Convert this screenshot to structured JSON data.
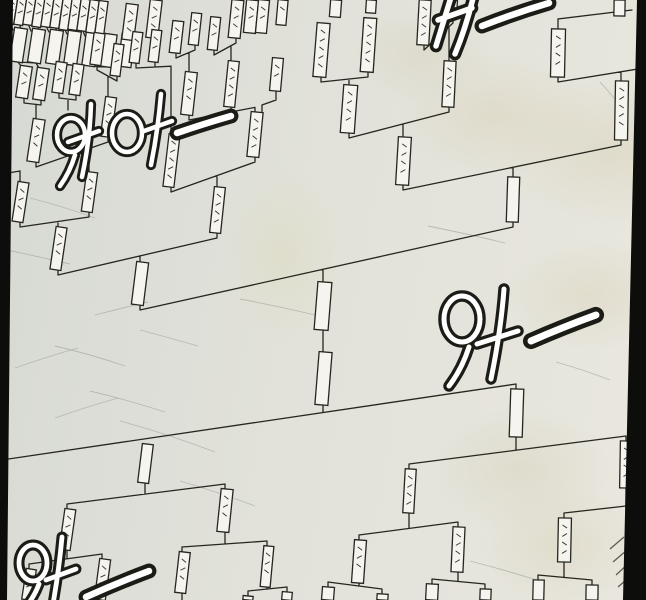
{
  "panel": {
    "scene_label": "tournament-bracket-wall",
    "sfx": [
      {
        "id": "cheer-top-left",
        "text": "와아—"
      },
      {
        "id": "cheer-top-right",
        "text": "와—"
      },
      {
        "id": "cheer-middle",
        "text": "와—"
      },
      {
        "id": "cheer-bottom-left",
        "text": "와—"
      }
    ]
  },
  "colors": {
    "ink": "#26261f",
    "box_fill": "#f5f4ee",
    "scribble": "#20201b",
    "scratch": "#a9aea6",
    "hatch": "#3b3b36",
    "border": "#0d0d0b"
  },
  "bracket": {
    "boxes": [
      [
        7,
        -6,
        9,
        30
      ],
      [
        16,
        -5,
        9,
        30
      ],
      [
        25,
        -5,
        9,
        30
      ],
      [
        34,
        -4,
        9,
        31
      ],
      [
        43,
        -4,
        9,
        31
      ],
      [
        52,
        -3,
        9,
        31
      ],
      [
        61,
        -2,
        9,
        32
      ],
      [
        70,
        -2,
        9,
        32
      ],
      [
        79,
        -1,
        9,
        32
      ],
      [
        88,
        0,
        9,
        33
      ],
      [
        97,
        1,
        9,
        33
      ],
      [
        12,
        28,
        13,
        34,
        0
      ],
      [
        30,
        29,
        13,
        34,
        0
      ],
      [
        48,
        30,
        13,
        34,
        0
      ],
      [
        66,
        31,
        13,
        34,
        0
      ],
      [
        84,
        33,
        13,
        33,
        0
      ],
      [
        102,
        34,
        13,
        33,
        0
      ],
      [
        120,
        34,
        13,
        33,
        0
      ],
      [
        124,
        4,
        12,
        36
      ],
      [
        148,
        0,
        12,
        38
      ],
      [
        230,
        0,
        12,
        38
      ],
      [
        245,
        0,
        12,
        33
      ],
      [
        257,
        0,
        11,
        33
      ],
      [
        277,
        0,
        10,
        25
      ],
      [
        330,
        0,
        11,
        17,
        0
      ],
      [
        366,
        0,
        10,
        13,
        0
      ],
      [
        418,
        0,
        12,
        45
      ],
      [
        446,
        0,
        11,
        18
      ],
      [
        614,
        0,
        11,
        16
      ],
      [
        18,
        66,
        12,
        32
      ],
      [
        35,
        68,
        12,
        32
      ],
      [
        54,
        62,
        11,
        31
      ],
      [
        71,
        64,
        11,
        31
      ],
      [
        92,
        33,
        11,
        32
      ],
      [
        112,
        44,
        10,
        32
      ],
      [
        131,
        32,
        10,
        31
      ],
      [
        150,
        30,
        10,
        32
      ],
      [
        171,
        21,
        11,
        32
      ],
      [
        190,
        13,
        10,
        32
      ],
      [
        209,
        17,
        10,
        33
      ],
      [
        271,
        58,
        11,
        33
      ],
      [
        315,
        23,
        13,
        54
      ],
      [
        362,
        18,
        13,
        54
      ],
      [
        30,
        119,
        12,
        43
      ],
      [
        103,
        97,
        11,
        40
      ],
      [
        183,
        72,
        12,
        43
      ],
      [
        226,
        61,
        11,
        46
      ],
      [
        166,
        134,
        11,
        53
      ],
      [
        249,
        112,
        12,
        45
      ],
      [
        15,
        182,
        11,
        40
      ],
      [
        84,
        172,
        11,
        40
      ],
      [
        342,
        85,
        14,
        48
      ],
      [
        443,
        61,
        12,
        46
      ],
      [
        551,
        29,
        14,
        48
      ],
      [
        53,
        227,
        11,
        43
      ],
      [
        212,
        187,
        11,
        46
      ],
      [
        397,
        137,
        13,
        48
      ],
      [
        615,
        81,
        13,
        59
      ],
      [
        134,
        262,
        12,
        43,
        0
      ],
      [
        507,
        177,
        12,
        45,
        0
      ],
      [
        316,
        282,
        14,
        48,
        0
      ],
      [
        317,
        352,
        13,
        53,
        0
      ],
      [
        140,
        444,
        11,
        39,
        0
      ],
      [
        510,
        389,
        13,
        48,
        0
      ],
      [
        62,
        509,
        11,
        41
      ],
      [
        219,
        489,
        12,
        43
      ],
      [
        404,
        469,
        11,
        44
      ],
      [
        620,
        441,
        12,
        47
      ],
      [
        24,
        569,
        10,
        31
      ],
      [
        97,
        559,
        11,
        41
      ],
      [
        177,
        552,
        11,
        41
      ],
      [
        262,
        546,
        10,
        41
      ],
      [
        353,
        540,
        12,
        43
      ],
      [
        452,
        527,
        12,
        45
      ],
      [
        558,
        518,
        13,
        44
      ],
      [
        322,
        587,
        12,
        13
      ],
      [
        377,
        594,
        11,
        6
      ],
      [
        426,
        584,
        12,
        16
      ],
      [
        480,
        589,
        11,
        11
      ],
      [
        533,
        580,
        11,
        20
      ],
      [
        586,
        585,
        12,
        15
      ],
      [
        243,
        596,
        10,
        4
      ],
      [
        282,
        592,
        10,
        8
      ]
    ],
    "connectors": [
      {
        "a": [
          24,
          98
        ],
        "b": [
          41,
          100
        ],
        "p": [
          36,
          119
        ],
        "d": 1
      },
      {
        "a": [
          97,
          65
        ],
        "b": [
          117,
          76
        ],
        "p": [
          108,
          97
        ],
        "d": 1
      },
      {
        "a": [
          176,
          53
        ],
        "b": [
          195,
          45
        ],
        "p": [
          189,
          72
        ],
        "d": 1
      },
      {
        "a": [
          214,
          50
        ],
        "b": [
          236,
          38
        ],
        "p": [
          231,
          61
        ],
        "d": 1
      },
      {
        "a": [
          189,
          115
        ],
        "b": [
          231,
          107
        ],
        "p": [
          255,
          112
        ],
        "d": 1
      },
      {
        "a": [
          36,
          162
        ],
        "b": [
          108,
          137
        ],
        "p": [
          89,
          172
        ],
        "d": 1
      },
      {
        "a": [
          20,
          222
        ],
        "b": [
          89,
          212
        ],
        "p": [
          58,
          227
        ],
        "d": 1
      },
      {
        "a": [
          171,
          187
        ],
        "b": [
          255,
          157
        ],
        "p": [
          217,
          187
        ],
        "d": 1
      },
      {
        "a": [
          136,
          63
        ],
        "b": [
          155,
          62
        ],
        "p": [
          171,
          134
        ],
        "d": 1
      },
      {
        "a": [
          59,
          93
        ],
        "b": [
          76,
          95
        ],
        "p": [
          68,
          110
        ],
        "d": 1
      },
      {
        "a": [
          58,
          270
        ],
        "b": [
          217,
          233
        ],
        "p": [
          140,
          262
        ],
        "d": 1
      },
      {
        "a": [
          321,
          77
        ],
        "b": [
          368,
          72
        ],
        "p": [
          349,
          85
        ],
        "d": 1
      },
      {
        "a": [
          424,
          45
        ],
        "b": [
          453,
          18
        ],
        "p": [
          449,
          61
        ],
        "d": 1
      },
      {
        "a": [
          349,
          133
        ],
        "b": [
          449,
          107
        ],
        "p": [
          403,
          137
        ],
        "d": 1
      },
      {
        "a": [
          558,
          77
        ],
        "b": [
          644,
          63
        ],
        "p": [
          621,
          81
        ],
        "d": 1
      },
      {
        "a": [
          403,
          185
        ],
        "b": [
          621,
          140
        ],
        "p": [
          513,
          177
        ],
        "d": 1
      },
      {
        "a": [
          140,
          305
        ],
        "b": [
          513,
          222
        ],
        "p": [
          323,
          282
        ],
        "d": 1
      },
      {
        "a": [
          -5,
          466
        ],
        "b": [
          516,
          389
        ],
        "p": [
          323,
          405
        ],
        "d": -1
      },
      {
        "a": [
          67,
          509
        ],
        "b": [
          225,
          489
        ],
        "p": [
          145,
          483
        ],
        "d": -1
      },
      {
        "a": [
          29,
          569
        ],
        "b": [
          102,
          559
        ],
        "p": [
          67,
          550
        ],
        "d": -1
      },
      {
        "a": [
          182,
          552
        ],
        "b": [
          267,
          546
        ],
        "p": [
          225,
          532
        ],
        "d": -1
      },
      {
        "a": [
          248,
          596
        ],
        "b": [
          287,
          592
        ],
        "p": [
          267,
          587
        ],
        "d": -1
      },
      {
        "a": [
          409,
          469
        ],
        "b": [
          626,
          441
        ],
        "p": [
          516,
          437
        ],
        "d": -1
      },
      {
        "a": [
          359,
          540
        ],
        "b": [
          458,
          527
        ],
        "p": [
          409,
          513
        ],
        "d": -1
      },
      {
        "a": [
          328,
          587
        ],
        "b": [
          382,
          594
        ],
        "p": [
          359,
          583
        ],
        "d": -1
      },
      {
        "a": [
          432,
          584
        ],
        "b": [
          485,
          589
        ],
        "p": [
          458,
          572
        ],
        "d": -1
      },
      {
        "a": [
          564,
          518
        ],
        "b": [
          644,
          509
        ],
        "p": [
          626,
          488
        ],
        "d": -1
      },
      {
        "a": [
          538,
          580
        ],
        "b": [
          592,
          585
        ],
        "p": [
          564,
          562
        ],
        "d": -1
      }
    ],
    "segments": [
      [
        323,
        330,
        323,
        352
      ],
      [
        20,
        182,
        20,
        171,
        8,
        173
      ],
      [
        558,
        29,
        558,
        19,
        632,
        10
      ],
      [
        619,
        16,
        619,
        11
      ],
      [
        182,
        593,
        182,
        600
      ],
      [
        276,
        91,
        276,
        100,
        262,
        105,
        262,
        112
      ],
      [
        130,
        40,
        130,
        50
      ],
      [
        154,
        38,
        154,
        46
      ],
      [
        11,
        25,
        13,
        30
      ],
      [
        20,
        26,
        22,
        31
      ],
      [
        29,
        26,
        31,
        31
      ],
      [
        38,
        27,
        40,
        32
      ],
      [
        47,
        28,
        49,
        32
      ],
      [
        56,
        29,
        58,
        33
      ],
      [
        65,
        30,
        67,
        34
      ],
      [
        74,
        30,
        76,
        35
      ],
      [
        83,
        31,
        85,
        36
      ],
      [
        92,
        32,
        94,
        37
      ],
      [
        101,
        33,
        103,
        38
      ],
      [
        18,
        62,
        21,
        66
      ],
      [
        36,
        63,
        39,
        68
      ],
      [
        72,
        65,
        75,
        70
      ],
      [
        18,
        62,
        36,
        63
      ],
      [
        54,
        64,
        72,
        65
      ],
      [
        90,
        66,
        108,
        67
      ]
    ],
    "scratches": [
      "M30,198 Q62,206 95,218",
      "M2,249 Q36,256 70,264",
      "M120,421 Q168,434 215,452",
      "M55,346 Q90,354 125,366",
      "M428,226 Q468,234 505,243",
      "M180,481 Q218,492 255,506",
      "M90,391 Q128,400 165,412",
      "M240,299 Q278,306 315,315",
      "M15,368 Q46,357 78,348",
      "M470,561 Q505,570 540,581",
      "M556,362 Q584,370 610,380",
      "M95,315 Q122,308 148,302",
      "M55,418 Q86,407 118,398",
      "M600,82 Q612,95 622,108",
      "M140,330 Q170,338 198,346"
    ],
    "hatches": [
      "M610,549 L624,537",
      "M613,562 L627,550",
      "M616,575 L630,562",
      "M618,587 L633,574"
    ]
  }
}
